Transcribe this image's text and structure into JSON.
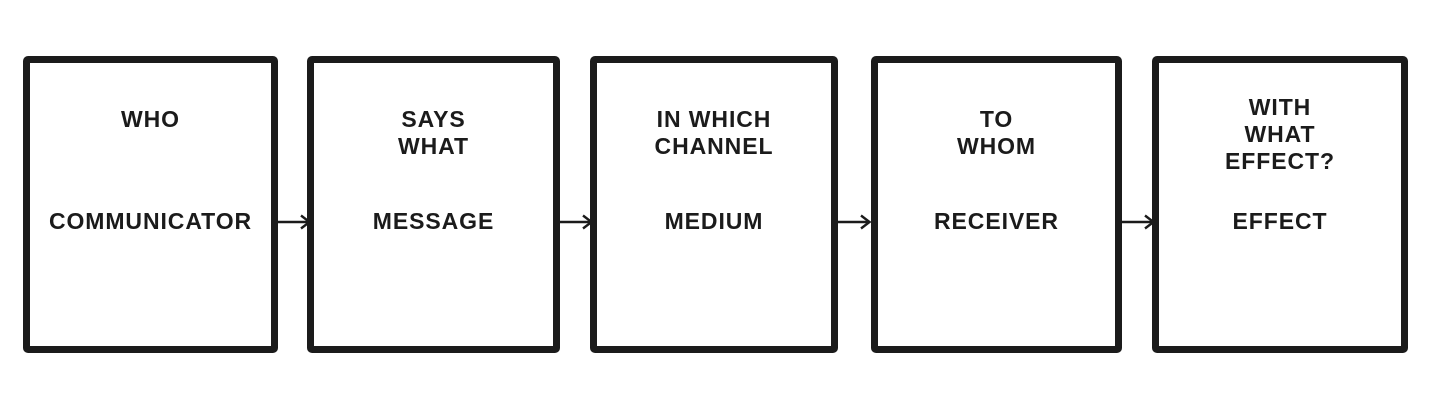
{
  "colors": {
    "ink": "#1b1b1b",
    "background": "#ffffff"
  },
  "diagram": {
    "model": "communication flow",
    "boxes": [
      {
        "question": "WHO",
        "element": "COMMUNICATOR"
      },
      {
        "question": "SAYS\nWHAT",
        "element": "MESSAGE"
      },
      {
        "question": "IN WHICH\nCHANNEL",
        "element": "MEDIUM"
      },
      {
        "question": "TO\nWHOM",
        "element": "RECEIVER"
      },
      {
        "question": "WITH\nWHAT\nEFFECT?",
        "element": "EFFECT"
      }
    ]
  }
}
